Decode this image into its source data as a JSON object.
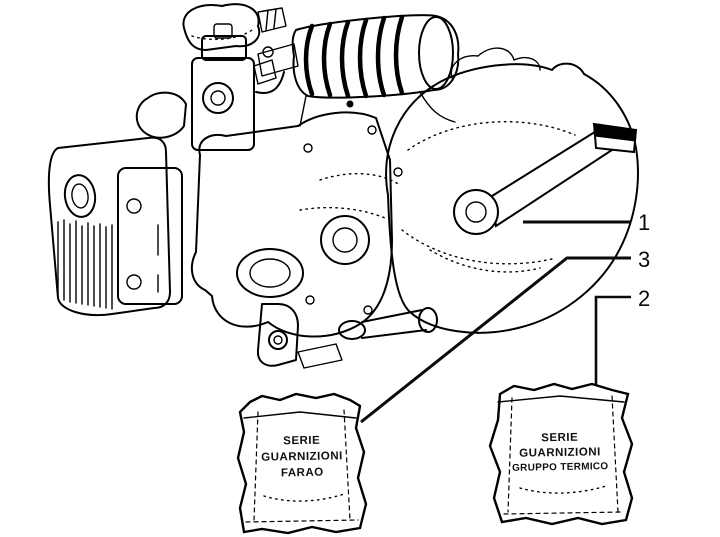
{
  "figure": {
    "type": "engine-parts-diagram",
    "background_color": "#ffffff",
    "line_color": "#000000"
  },
  "callouts": [
    {
      "number": "1",
      "points_to": "engine-assembly"
    },
    {
      "number": "3",
      "points_to": "gasket-bag-left"
    },
    {
      "number": "2",
      "points_to": "gasket-bag-right"
    }
  ],
  "bags": {
    "left": {
      "lines": [
        "SERIE",
        "GUARNIZIONI",
        "FARAO"
      ]
    },
    "right": {
      "lines": [
        "SERIE",
        "GUARNIZIONI",
        "GRUPPO TERMICO"
      ]
    }
  }
}
